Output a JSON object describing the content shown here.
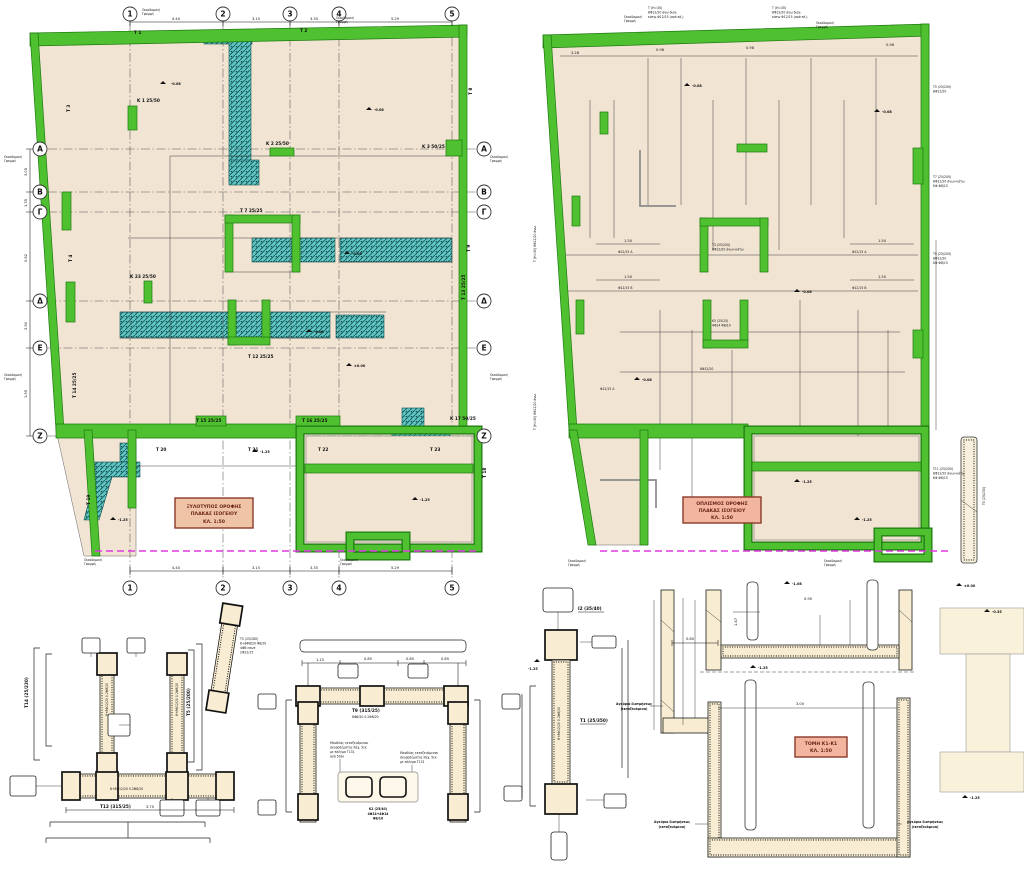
{
  "lp": {
    "cols": [
      "1",
      "2",
      "3",
      "4",
      "5"
    ],
    "rows": [
      "A",
      "B",
      "Γ",
      "Δ",
      "E",
      "Z"
    ],
    "dt": [
      "4.40",
      "3.15",
      "3.35",
      "5.29"
    ],
    "db": [
      "4.40",
      "3.15",
      "3.35",
      "5.29"
    ],
    "sd": [
      "3.05",
      "1.35",
      "0.62",
      "3.90",
      "1.95"
    ],
    "bl1": "Οικοδομική",
    "bl2": "Γραμμή",
    "title": [
      "ΞΥΛΟΤΥΠΟΣ ΟΡΟΦΗΣ",
      "ΠΛΑΚΑΣ ΙΣΟΓΕΙΟΥ",
      "ΚΛ. 1:50"
    ],
    "lab": {
      "k1": "K 1 25/50",
      "k2": "K 2 25/50",
      "k3": "K 3 50/25",
      "k23": "K 23 25/50",
      "k17": "K 17 50/25",
      "t1": "T 1",
      "t2": "T 2",
      "t3": "T 3",
      "t4": "T 4",
      "t7": "T 7 25/25",
      "t8": "T 8",
      "t9": "T 9",
      "t12": "T 12 25/25",
      "t13": "T 13 25/25",
      "t14": "T 14 25/25",
      "t15": "T 15 25/25",
      "t16": "T 16 25/25",
      "t18": "T 18",
      "t19": "T 19",
      "t20": "T 20",
      "t21": "T 21",
      "t22": "T 22",
      "t23": "T 23"
    },
    "elev": [
      "-0.08",
      "-0.08",
      "-0.08",
      "±0.00",
      "-1.25",
      "-1.25",
      "-0.08",
      "-1.25"
    ]
  },
  "rp": {
    "dt": [
      "3.28",
      "0.98",
      "0.98",
      "0.98"
    ],
    "bl1": "Οικοδομική",
    "bl2": "Γραμμή",
    "title": [
      "ΟΠΛΙΣΜΟΣ ΟΡΟΦΗΣ",
      "ΠΛΑΚΑΣ ΙΣΟΓΕΙΟΥ",
      "ΚΛ. 1:50"
    ],
    "note": [
      "Τ (Η=30)",
      "8Φ12/20 άνω διαν.",
      "κάτω Φ12/15 (ανά πλ.)"
    ],
    "sides": {
      "s1": [
        "Τ5 (25/200)",
        "8Φ12/20"
      ],
      "s2": [
        "Τ7 (25/200)",
        "8Φ12/20 άνω+κάτω",
        "ΚΦ Φ8/15"
      ],
      "s3": [
        "Τ9 (25/200)",
        "8Φ12/20",
        "ΚΦ Φ8/15"
      ],
      "s4": [
        "Τ11 (25/200)",
        "8Φ12/20 άνω+κάτω",
        "ΚΦ Φ8/15"
      ]
    },
    "shaft": [
      "Τ3 (25/200)",
      "8Φ12/20 άνω+κάτω"
    ],
    "shaft2": [
      "Κ5 (25/25)",
      "4Φ14 Φ8/10"
    ],
    "tags": [
      "Φ12/15 Α",
      "Φ12/15 Β",
      "8Φ12/20",
      "Φ12/15 Α",
      "Φ12/15 Β",
      "Φ12/15 Α"
    ],
    "dims": [
      "1.50",
      "1.50",
      "1.50",
      "1.50"
    ],
    "vnote": "Τ (Η=30) 8Φ12/20 άνω",
    "elev": [
      "-0.08",
      "-0.08",
      "-0.08",
      "-0.08",
      "-1.25",
      "-1.25"
    ],
    "bar": "Τ5 (25/230)"
  },
  "d1": {
    "t14": "T14 (25/230)",
    "t5s": "T5 (25/200)",
    "t12": "T12 (315/25)",
    "blk": [
      "T5 (25/280)",
      "8+8Φ8/20 Φ8/20",
      "4Φ8 εσωτ.",
      "2Φ12/15"
    ],
    "bars": "8+8Φ12/20 0.2Φ8/20",
    "dim": "3.70"
  },
  "d2": {
    "t9": "T9 (315/25)",
    "t9b": "8Φ8/20 0.2Φ8/20",
    "note1": [
      "Μανδύας εκτοξευόμενου",
      "σκυροδέματος πάχ. 5εκ",
      "με πλέγμα Τ131",
      "ανά 50εκ"
    ],
    "note2": [
      "Μανδύας εκτοξευόμενου",
      "σκυροδέματος πάχ. 5εκ",
      "με πλέγμα Τ131"
    ],
    "k2": "K2 (25/40)",
    "k2b": [
      "4Φ14+4Φ14",
      "Φ8/10"
    ],
    "dims": [
      "1.15",
      "0.85",
      "0.85",
      "0.85"
    ],
    "bars": "8+8Φ12/20 0.2Φ8/20"
  },
  "d3": {
    "i2": "I2 (35/40)",
    "t1": "T1 (25/350)",
    "bars": "8+8Φ12/20 0.2Φ8/20",
    "e": "-1.25"
  },
  "d4": {
    "box": [
      "ΤΟΜΗ Κ1-Κ1",
      "ΚΛ. 1:50"
    ],
    "anch": [
      "Αγκύρια διατμήσεως",
      "(εκτοξευόμενα)"
    ],
    "elev": [
      "±0.00",
      "-0.35",
      "-1.25",
      "-1.08",
      "-1.25"
    ],
    "dims": [
      "0.60",
      "1.47",
      "3.00",
      "0.90"
    ]
  }
}
